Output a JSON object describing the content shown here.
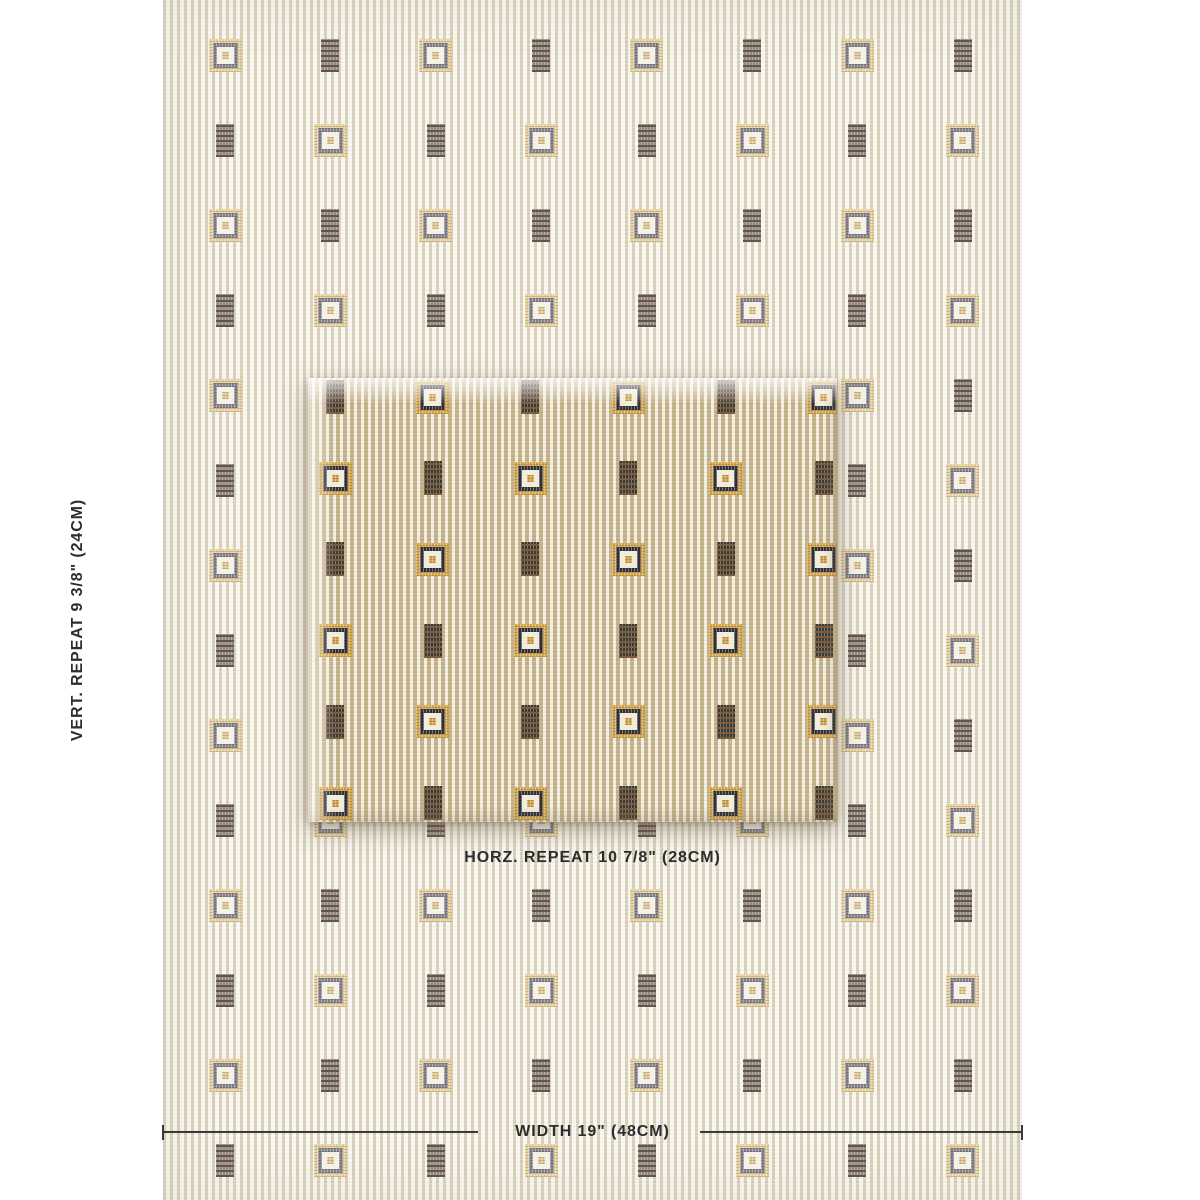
{
  "labels": {
    "vertical_repeat": "VERT. REPEAT 9 3/8\" (24CM)",
    "horizontal_repeat": "HORZ. REPEAT 10 7/8\" (28CM)",
    "width": "WIDTH 19\" (48CM)",
    "text_color": "#2d2d2d"
  },
  "measure_line": {
    "y": 1131,
    "x_start": 163,
    "x_end": 1022,
    "gap_start": 478,
    "gap_end": 700,
    "tick_height": 15,
    "color": "#3a3a3a"
  },
  "fabric_background": {
    "x": 163,
    "y": 0,
    "width": 859,
    "height": 1200,
    "stripes": {
      "dark": "#d9d0ba",
      "light": "#f9f7ef",
      "dark_px": 3,
      "period_px": 7
    },
    "grid": {
      "start_x": 62,
      "start_y": 55,
      "col_spacing": 105.4,
      "row_spacing": 85,
      "cols": 8,
      "rows": 14,
      "even_motif": "framed",
      "odd_motif": "dark"
    },
    "motifs": {
      "framed": {
        "w": 33,
        "h": 33,
        "gold": "#e7d09b",
        "dark": "#85828b",
        "inner": "#f5f1e6",
        "center": "#e2c88f"
      },
      "dark": {
        "w": 18,
        "h": 33,
        "base": "#968а7c-fix",
        "base_fix": "#96897c",
        "accent": "#5f564f"
      }
    }
  },
  "swatch": {
    "x": 308,
    "y": 378,
    "width": 529,
    "height": 444,
    "stripes": {
      "dark": "#c3b087",
      "light": "#f3eee0",
      "dark_px": 4,
      "period_px": 7
    },
    "grid": {
      "start_x": 27,
      "start_y": 19,
      "col_spacing": 97.7,
      "row_spacing": 81.2,
      "cols": 6,
      "rows": 6,
      "even_motif": "dark",
      "odd_motif": "framed"
    },
    "motifs": {
      "framed": {
        "w": 33,
        "h": 33,
        "gold": "#d6a649",
        "dark": "#33323a",
        "inner": "#f2ecda",
        "center": "#d2a347"
      },
      "dark": {
        "w": 18,
        "h": 34,
        "base": "#3b3832",
        "base_fix": "#3b3832",
        "accent": "#7d5c3c"
      }
    }
  }
}
